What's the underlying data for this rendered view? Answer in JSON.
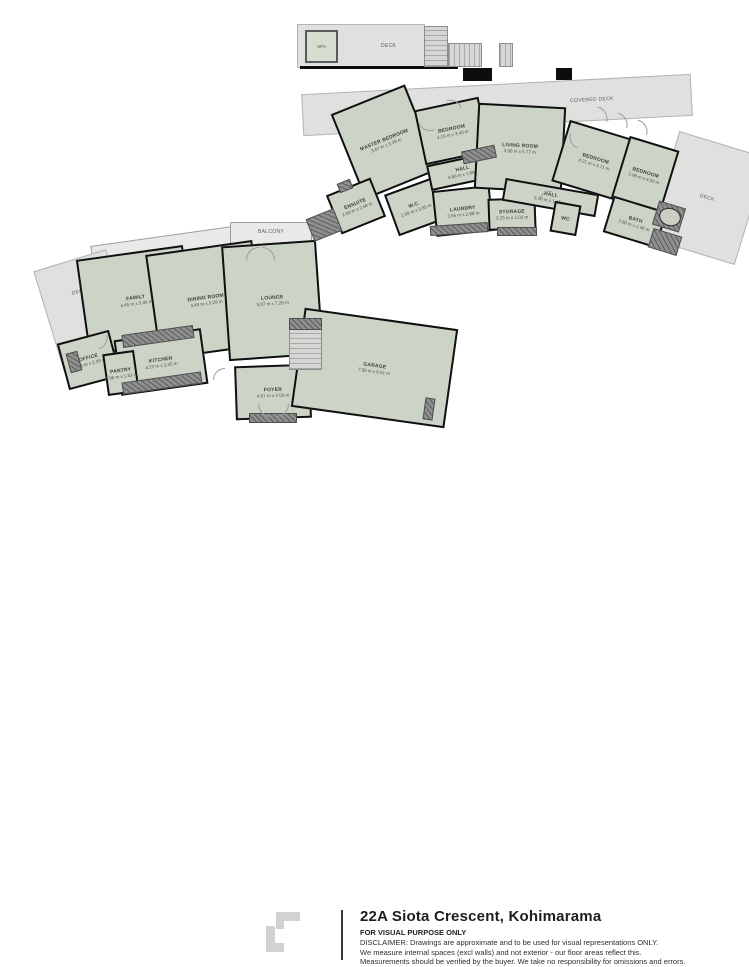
{
  "colors": {
    "room_fill": "#ccd4c7",
    "deck_fill": "#e0e0df",
    "wall": "#0d0d0d",
    "fixture_gray": "#8f8f8f",
    "text_dark": "#1e1e1e"
  },
  "floors": {
    "upper": {
      "rooms": [
        {
          "label": "MASTER BEDROOM",
          "dims": "3.67 m x 5.29 m"
        },
        {
          "label": "ENSUITE",
          "dims": "2.00 m x 2.48 m"
        },
        {
          "label": "W.C.",
          "dims": "2.09 m x 3.65 m"
        },
        {
          "label": "BEDROOM",
          "dims": "4.15 m x 3.43 m"
        },
        {
          "label": "HALL",
          "dims": "4.80 m x 1.86 m"
        },
        {
          "label": "LAUNDRY",
          "dims": "3.55 m x 2.88 m"
        },
        {
          "label": "STORAGE",
          "dims": "3.25 m x 2.03 m"
        },
        {
          "label": "LIVING ROOM",
          "dims": "3.90 m x 5.77 m"
        },
        {
          "label": "HALL",
          "dims": "6.70 m x 1.45 m"
        },
        {
          "label": "WC",
          "dims": "1.10 m x 1.57 m"
        },
        {
          "label": "BEDROOM",
          "dims": "4.21 m x 4.71 m"
        },
        {
          "label": "BEDROOM",
          "dims": "2.96 m x 4.00 m"
        },
        {
          "label": "BATH",
          "dims": "2.60 m x 2.46 m"
        }
      ],
      "areas": {
        "spa": "SPA",
        "deck_top": "DECK",
        "covered_deck": "COVERED DECK",
        "deck_right": "DECK"
      }
    },
    "lower": {
      "rooms": [
        {
          "label": "FAMILY",
          "dims": "4.45 m x 5.36 m"
        },
        {
          "label": "DINING ROOM",
          "dims": "4.49 m x 5.29 m"
        },
        {
          "label": "LOUNGE",
          "dims": "5.07 m x 7.26 m"
        },
        {
          "label": "KITCHEN",
          "dims": "4.23 m x 3.35 m"
        },
        {
          "label": "OFFICE",
          "dims": "2.26 m x 2.28 m"
        },
        {
          "label": "PANTRY",
          "dims": "1.96 m x 1.53 m"
        },
        {
          "label": "FOYER",
          "dims": "4.67 m x 2.05 m"
        },
        {
          "label": "GARAGE",
          "dims": "7.36 m x 6.51 m"
        }
      ],
      "areas": {
        "balcony_left": "BALCONY",
        "balcony_top": "BALCONY",
        "deck_left": "DECK"
      }
    }
  },
  "footer": {
    "title": "22A Siota Crescent, Kohimarama",
    "visual_purpose": "FOR VISUAL PURPOSE ONLY",
    "disclaimer_line1": "DISCLAIMER:  Drawings are approximate and to be used for visual representations ONLY.",
    "disclaimer_line2": "We measure internal spaces (excl walls) and not exterior - our floor areas reflect this.",
    "disclaimer_line3": "Measurements should be verified by the buyer. We take no responsibility for omissions and errors."
  }
}
